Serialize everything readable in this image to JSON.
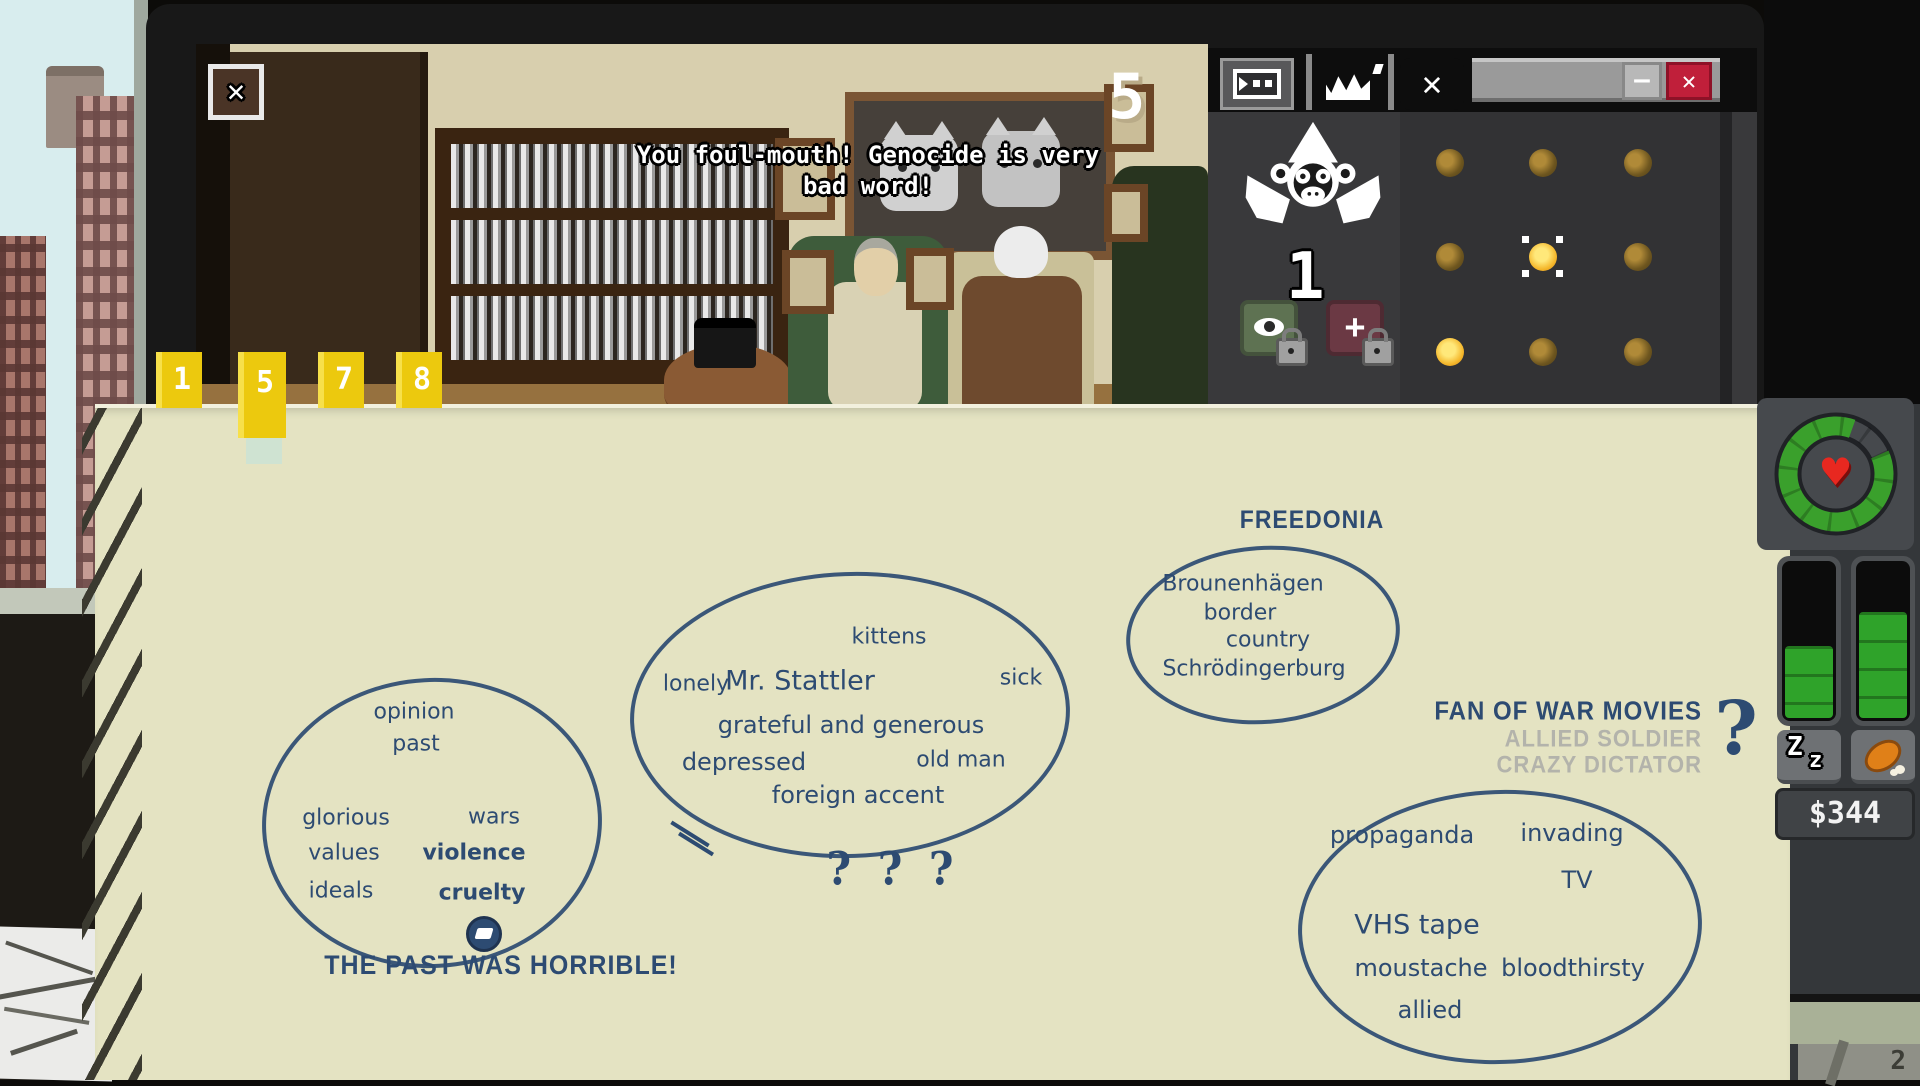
{
  "colors": {
    "ink": "#2d4b72",
    "muted_text": "#b3b3ab",
    "paper": "#e4e3c2",
    "tab_yellow": "#ecc90e",
    "close_red": "#c01f3a",
    "hud_green": "#35a02c",
    "heart_red": "#e82820",
    "gold_bright": "#f4b62a",
    "gold_dim": "#6e561f"
  },
  "scene": {
    "close_glyph": "✕",
    "countdown": "5",
    "dialogue_line1": "You foul-mouth! Genocide is very",
    "dialogue_line2": "bad word!"
  },
  "monkey_window": {
    "count": "1",
    "x_tab_glyph": "✕",
    "minimize_glyph": "–",
    "close_glyph": "✕",
    "plus_glyph": "+",
    "cage_grid": [
      "dim",
      "dim",
      "dim",
      "dim",
      "selected",
      "dim",
      "bright",
      "dim",
      "dim"
    ]
  },
  "notepad": {
    "page_tabs": [
      "1",
      "5",
      "7",
      "8"
    ],
    "selected_tab": "5",
    "groups": [
      {
        "words": [
          "opinion",
          "past",
          "glorious",
          "wars",
          "values",
          "violence",
          "ideals",
          "cruelty"
        ],
        "conclusion": "THE PAST WAS HORRIBLE!"
      },
      {
        "words": [
          "kittens",
          "lonely",
          "Mr. Stattler",
          "sick",
          "grateful and generous",
          "depressed",
          "old man",
          "foreign accent"
        ],
        "conclusion": "? ? ?"
      },
      {
        "label": "FREEDONIA",
        "words": [
          "Brounenhägen",
          "border",
          "country",
          "Schrödingerburg"
        ]
      },
      {
        "words": [
          "propaganda",
          "invading",
          "TV",
          "VHS tape",
          "moustache",
          "bloodthirsty",
          "allied"
        ]
      }
    ],
    "hypotheses": {
      "options": [
        {
          "label": "FAN OF WAR MOVIES",
          "state": "active"
        },
        {
          "label": "ALLIED SOLDIER",
          "state": "rejected"
        },
        {
          "label": "CRAZY DICTATOR",
          "state": "rejected"
        }
      ],
      "mark": "?"
    }
  },
  "hud": {
    "money": "$344",
    "heart_glyph": "♥",
    "sleep_glyph_big": "Z",
    "sleep_glyph_small": "z",
    "health_percent": 87,
    "sleep_percent": 45,
    "food_percent": 66,
    "calendar_digit": "2"
  }
}
